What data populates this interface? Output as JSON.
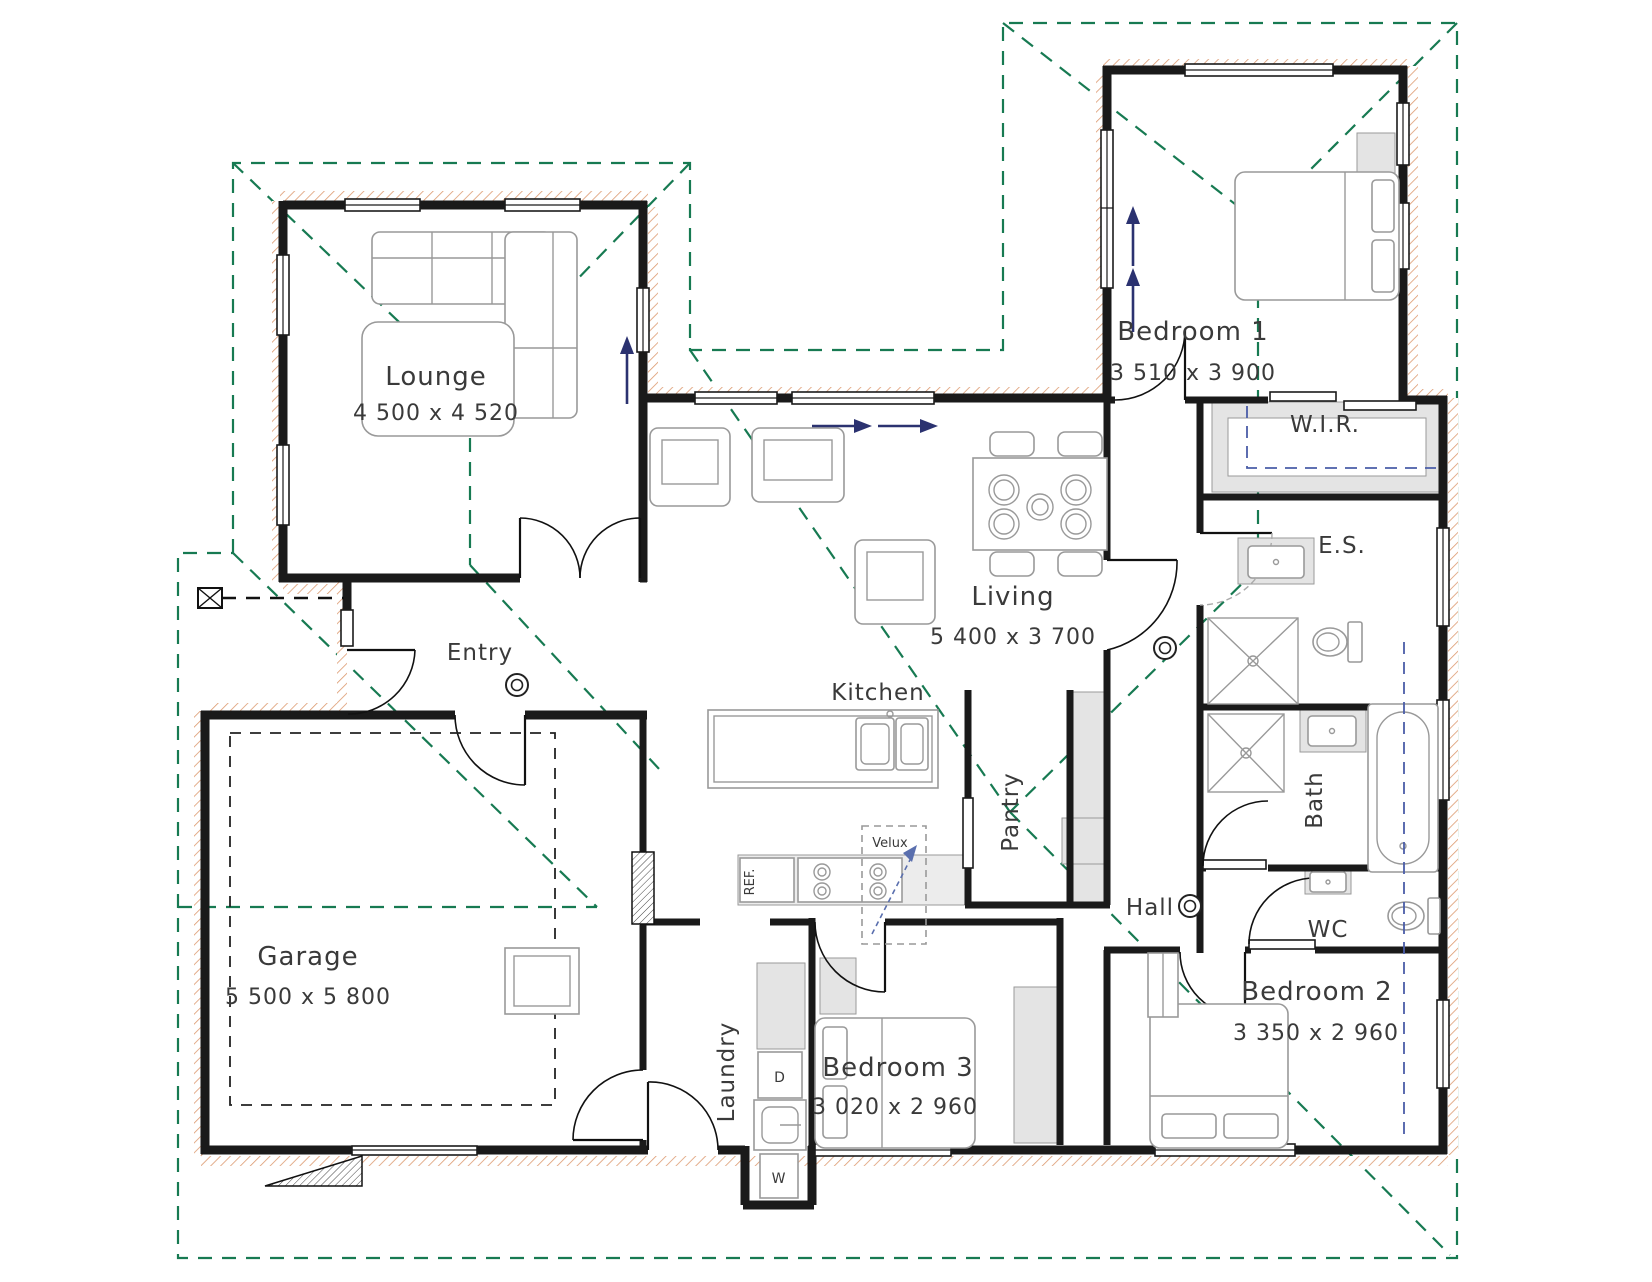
{
  "rooms": {
    "lounge": {
      "name": "Lounge",
      "dims": "4 500 x 4 520"
    },
    "entry": {
      "name": "Entry"
    },
    "garage": {
      "name": "Garage",
      "dims": "5 500 x 5 800"
    },
    "living": {
      "name": "Living",
      "dims": "5 400 x 3 700"
    },
    "kitchen": {
      "name": "Kitchen"
    },
    "pantry": {
      "name": "Pantry"
    },
    "laundry": {
      "name": "Laundry"
    },
    "hall": {
      "name": "Hall"
    },
    "bath": {
      "name": "Bath"
    },
    "wc": {
      "name": "WC"
    },
    "wir": {
      "name": "W.I.R."
    },
    "es": {
      "name": "E.S."
    },
    "bedroom1": {
      "name": "Bedroom 1",
      "dims": "3 510 x 3 900"
    },
    "bedroom2": {
      "name": "Bedroom 2",
      "dims": "3 350 x 2 960"
    },
    "bedroom3": {
      "name": "Bedroom 3",
      "dims": "3 020 x 2 960"
    }
  },
  "annotations": {
    "velux": "Velux",
    "dryer": "D",
    "washer": "W",
    "fridge": "REF."
  },
  "colors": {
    "wall": "#1a1a1a",
    "roofline": "#177a52",
    "ceiling_line": "#4a5da8",
    "arrow": "#2b3270",
    "brick_hatch": "#dd9a70",
    "fixture": "#999999",
    "room_shading": "#e4e4e4",
    "velux_text": "#5a6fae",
    "text": "#3a3a3a"
  }
}
